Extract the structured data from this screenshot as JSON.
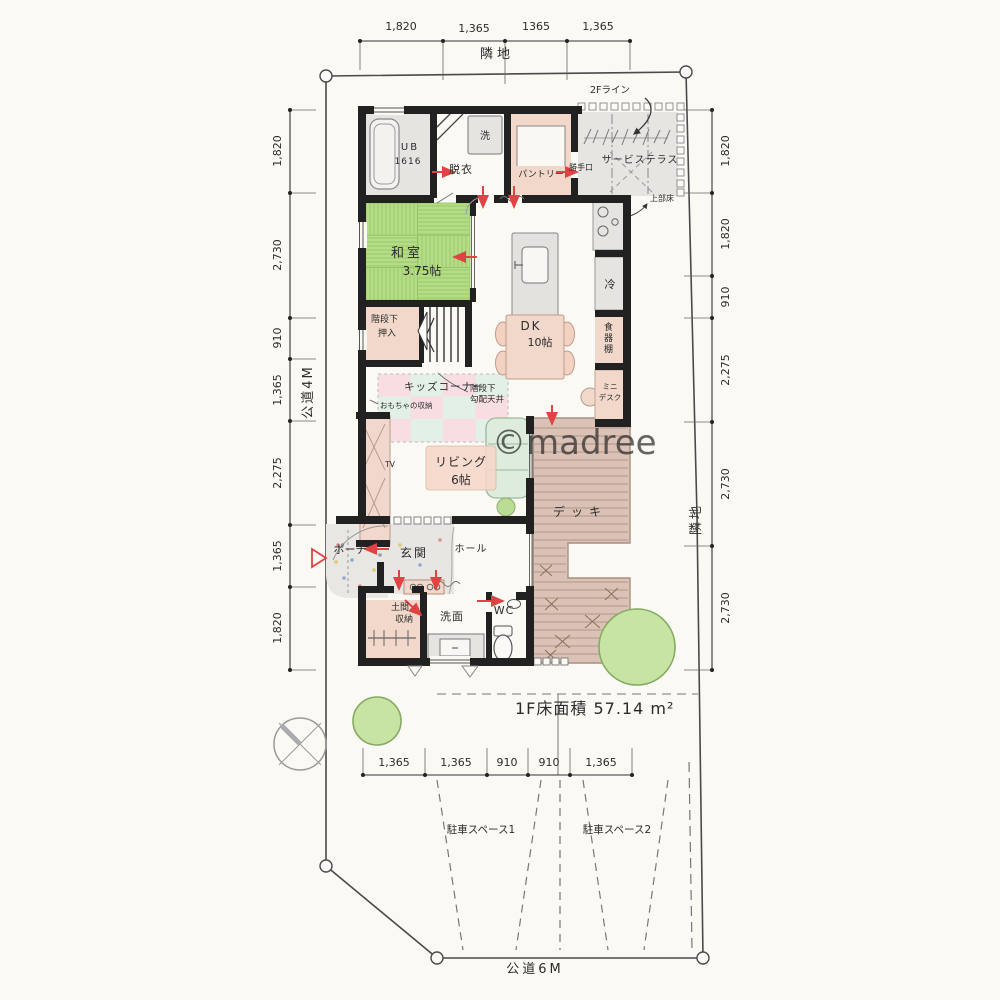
{
  "site": {
    "neighbor_top": "隣地",
    "neighbor_right": "隣地",
    "road_left": "公道4M",
    "road_bottom": "公道6M",
    "area_text": "1F床面積 57.14 m²",
    "watermark": "©madree"
  },
  "dimensions": {
    "top": [
      "1,820",
      "1,365",
      "1365",
      "1,365"
    ],
    "left": [
      "1,820",
      "2,730",
      "910",
      "1,365",
      "2,275",
      "1,365",
      "1,820"
    ],
    "right": [
      "1,820",
      "1,820",
      "910",
      "2,275",
      "2,730",
      "2,730"
    ],
    "bottom": [
      "1,365",
      "1,365",
      "910",
      "910",
      "1,365"
    ]
  },
  "rooms": {
    "ub1": "UB",
    "ub2": "1616",
    "laundry": "洗",
    "dressing": "脱衣",
    "pantry": "パントリー",
    "backdoor": "勝手口",
    "service_terrace": "サービステラス",
    "washitsu": "和室",
    "washitsu_size": "3.75帖",
    "fridge": "冷",
    "dk": "DK",
    "dk_size": "10帖",
    "cupboard": "食器棚",
    "minidesk1": "ミニ",
    "minidesk2": "デスク",
    "stair_closet1": "階段下",
    "stair_closet2": "押入",
    "kids_corner": "キッズコーナー",
    "toy_note": "おもちゃの収納",
    "living": "リビング",
    "living_size": "6帖",
    "tv": "TV",
    "deck": "デッキ",
    "porch": "ポーチ",
    "entrance": "玄関",
    "hall": "ホール",
    "doma1": "土間",
    "doma2": "収納",
    "washroom": "洗面",
    "wc": "WC"
  },
  "annotations": {
    "f2_line": "2Fライン",
    "upper_floor": "上部床",
    "under_stairs1": "階段下",
    "under_stairs2": "勾配天井"
  },
  "parking": [
    "駐車スペース1",
    "駐車スペース2"
  ],
  "colors": {
    "wall": "#212121",
    "accent_red": "#e04343",
    "tatami_green": "#b5dc87",
    "room_pink": "#f2d8ca",
    "room_gray": "#e6e4e0",
    "deck_brown": "#dac2b6",
    "kids_pink": "#f8dee3",
    "kids_mint": "#e2f0e5",
    "sofa_green": "#ddecdd",
    "tree_green": "#c8e4a3",
    "paper": "#fbf9f4"
  }
}
